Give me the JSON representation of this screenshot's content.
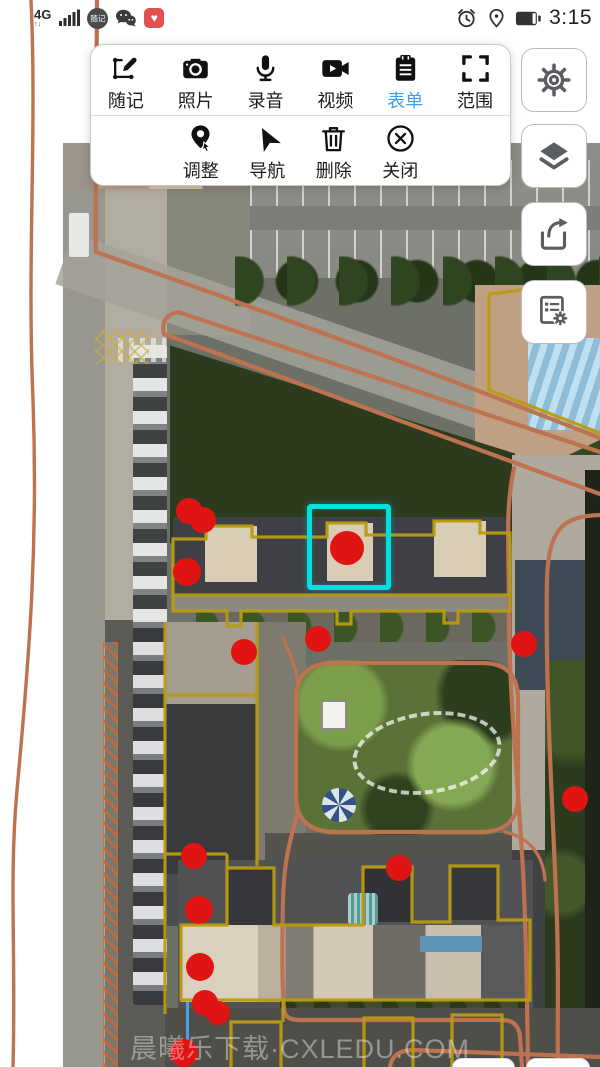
{
  "status_bar": {
    "network": "4G",
    "network_sub": "↑↓",
    "app_badge_label": "随记",
    "time": "3:15",
    "icons": [
      "signal-bars",
      "app-badge",
      "wechat",
      "red-app",
      "alarm-clock",
      "location",
      "battery"
    ]
  },
  "toolbar": {
    "row1": [
      {
        "label": "随记",
        "icon": "note-draw"
      },
      {
        "label": "照片",
        "icon": "camera"
      },
      {
        "label": "录音",
        "icon": "microphone"
      },
      {
        "label": "视频",
        "icon": "video"
      },
      {
        "label": "表单",
        "icon": "form",
        "active": true
      },
      {
        "label": "范围",
        "icon": "range"
      }
    ],
    "row2": [
      {
        "label": "调整",
        "icon": "adjust-pin"
      },
      {
        "label": "导航",
        "icon": "navigate"
      },
      {
        "label": "删除",
        "icon": "trash"
      },
      {
        "label": "关闭",
        "icon": "close-circle"
      }
    ],
    "active_color": "#3f9ef5"
  },
  "side_buttons": [
    {
      "icon": "settings-gear"
    },
    {
      "icon": "layers"
    },
    {
      "icon": "share"
    },
    {
      "icon": "form-settings"
    }
  ],
  "map": {
    "watermark": "晨曦乐下载·CXLEDU.COM",
    "marker_color": "#e11414",
    "selection": {
      "x": 307,
      "y": 504,
      "w": 84,
      "h": 86,
      "color": "#00e0e0"
    },
    "markers": [
      {
        "x": 189,
        "y": 511,
        "r": 13
      },
      {
        "x": 203,
        "y": 520,
        "r": 13
      },
      {
        "x": 187,
        "y": 572,
        "r": 14
      },
      {
        "x": 347,
        "y": 548,
        "r": 17
      },
      {
        "x": 244,
        "y": 652,
        "r": 13
      },
      {
        "x": 318,
        "y": 639,
        "r": 13
      },
      {
        "x": 524,
        "y": 644,
        "r": 13
      },
      {
        "x": 575,
        "y": 799,
        "r": 13
      },
      {
        "x": 194,
        "y": 856,
        "r": 13
      },
      {
        "x": 399,
        "y": 868,
        "r": 13
      },
      {
        "x": 199,
        "y": 910,
        "r": 14
      },
      {
        "x": 200,
        "y": 967,
        "r": 14
      },
      {
        "x": 205,
        "y": 1003,
        "r": 13
      },
      {
        "x": 218,
        "y": 1013,
        "r": 12
      },
      {
        "x": 184,
        "y": 1053,
        "r": 14
      }
    ],
    "paths": {
      "left_route": "M31,0 C37,130 27,260 33,400 C38,540 30,650 17,790 C9,880 16,950 13,1067",
      "road_top": "M97,0 L96,146 C96,200 95,230 96,252 C170,278 390,355 600,438",
      "diag_loop": "M600,452 L178,312 Q160,316 164,334 L600,494",
      "right_down_1": "M514,468 C505,510 509,548 509,612 C509,690 517,770 523,870 C527,950 527,1010 528,1067",
      "right_down_2": "M600,515 C562,516 549,530 547,578 C545,690 553,810 557,920 C559,990 557,1030 558,1067",
      "courtyard_loop": "M296,700 Q296,663 334,663 L482,663 Q518,663 518,699 L518,797 Q518,832 480,832 L336,832 Q296,832 296,796 Z",
      "courtyard_link": "M283,638 C291,656 296,668 298,682",
      "courtyard_corner": "M505,832 C530,838 543,855 545,880",
      "courtyard_exit": "M298,812 C290,840 284,860 283,900 C282,950 282,980 284,1010 Q285,1020 300,1020 L502,1020 Q518,1020 520,1036 L522,1067",
      "bottom_curve": "M390,1067 Q392,1051 412,1050 L600,1057"
    },
    "outlines": {
      "upper_main": "M173,539 L206,539 L206,526 L252,526 L252,537 L327,537 L327,523 L366,523 L366,535 L434,535 L434,521 L480,521 L480,533 L510,533 L510,595 L173,595 Z",
      "upper_south": "M173,595 L173,611 L227,611 L227,626 L241,626 L241,611 L337,611 L337,624 L351,624 L351,611 L444,611 L444,623 L458,623 L458,611 L510,611 L510,595",
      "wing": "M165,622 L165,1014 M257,622 L257,866 M165,695 L257,695 M165,854 L227,854 M227,854 L227,868",
      "lower_main": "M181,925 L227,925 L227,868 L274,868 L274,925 L363,925 L363,867 L412,867 L412,922 L450,922 L450,866 L498,866 L498,920 L530,920 L530,1000 L181,1000 Z",
      "bottom_sq1": "M231,1067 L231,1022 L281,1022 L281,1067",
      "bottom_sq2": "M364,1067 L364,1018 L413,1018 L413,1067",
      "bottom_sq3": "M452,1067 L452,1015 L502,1015 L502,1058",
      "connector": "M283,1000 L283,1022",
      "topright": "M489,294 L489,390 L600,433 M489,294 L556,286"
    }
  }
}
